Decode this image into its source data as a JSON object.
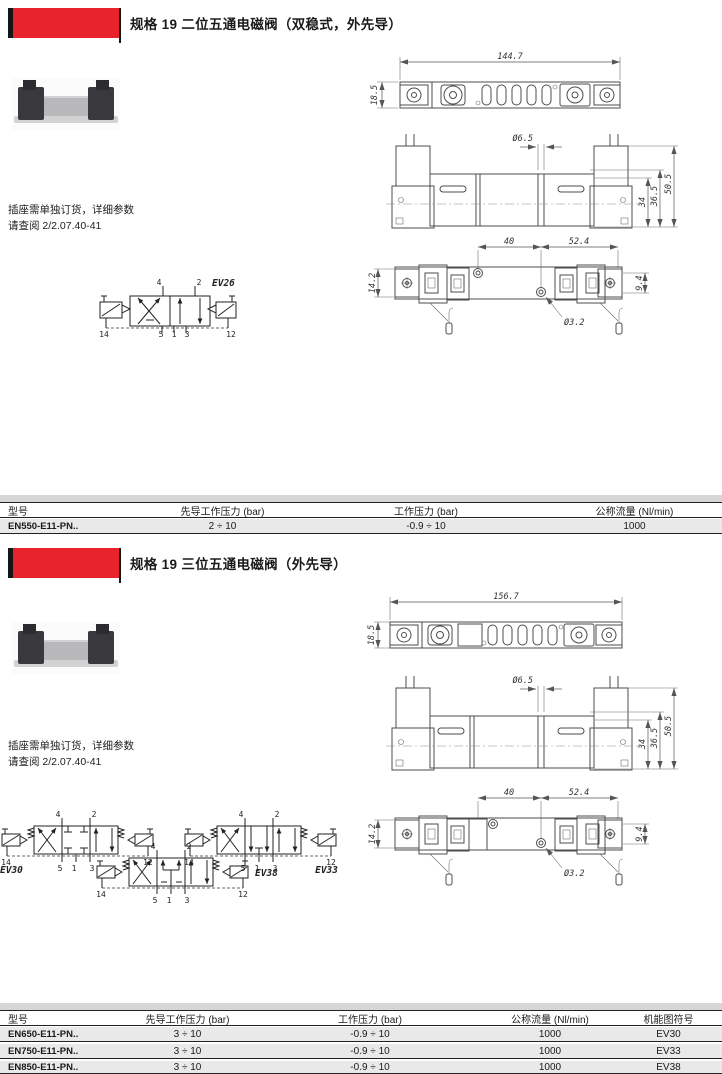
{
  "colors": {
    "accent_red": "#e8232b",
    "table_band_gray": "#d6d6d6",
    "table_row_gray": "#e9e9e9"
  },
  "section1": {
    "title": "规格 19 二位五通电磁阀（双稳式，外先导）",
    "note": {
      "line1": "插座需单独订货，详细参数",
      "line2": "请查阅 2/2.07.40-41"
    },
    "symbol": {
      "label": "EV26"
    },
    "ports": {
      "top": [
        "4",
        "2"
      ],
      "bottom": [
        "5",
        "1",
        "3"
      ],
      "left": "14",
      "right": "12"
    },
    "dims": {
      "top_length": "144.7",
      "top_height": "18.5",
      "front_hole": "Ø6.5",
      "front_h1": "34",
      "front_h2": "36.5",
      "front_h3": "50.5",
      "bottom_w1": "40",
      "bottom_w2": "52.4",
      "bottom_hl": "14.2",
      "bottom_hr": "9.4",
      "bottom_hole": "Ø3.2"
    },
    "table": {
      "headers": [
        "型号",
        "先导工作压力 (bar)",
        "工作压力 (bar)",
        "公称流量 (Nl/min)"
      ],
      "rows": [
        {
          "model": "EN550-E11-PN..",
          "pilot_pressure": "2 ÷ 10",
          "working_pressure": "-0.9 ÷ 10",
          "flow": "1000"
        }
      ]
    }
  },
  "section2": {
    "title": "规格 19 三位五通电磁阀（外先导）",
    "note": {
      "line1": "插座需单独订货，详细参数",
      "line2": "请查阅 2/2.07.40-41"
    },
    "symbols": [
      {
        "label": "EV30"
      },
      {
        "label": "EV33"
      },
      {
        "label": "EV38"
      }
    ],
    "ports": {
      "top": [
        "4",
        "2"
      ],
      "bottom": [
        "5",
        "1",
        "3"
      ],
      "left": "14",
      "right": "12"
    },
    "dims": {
      "top_length": "156.7",
      "top_height": "18.5",
      "front_hole": "Ø6.5",
      "front_h1": "34",
      "front_h2": "36.5",
      "front_h3": "50.5",
      "bottom_w1": "40",
      "bottom_w2": "52.4",
      "bottom_hl": "14.2",
      "bottom_hr": "9.4",
      "bottom_hole": "Ø3.2"
    },
    "table": {
      "headers": [
        "型号",
        "先导工作压力 (bar)",
        "工作压力 (bar)",
        "公称流量 (Nl/min)",
        "机能图符号"
      ],
      "rows": [
        {
          "model": "EN650-E11-PN..",
          "pilot_pressure": "3 ÷ 10",
          "working_pressure": "-0.9 ÷ 10",
          "flow": "1000",
          "symbol": "EV30"
        },
        {
          "model": "EN750-E11-PN..",
          "pilot_pressure": "3 ÷ 10",
          "working_pressure": "-0.9 ÷ 10",
          "flow": "1000",
          "symbol": "EV33"
        },
        {
          "model": "EN850-E11-PN..",
          "pilot_pressure": "3 ÷ 10",
          "working_pressure": "-0.9 ÷ 10",
          "flow": "1000",
          "symbol": "EV38"
        }
      ]
    }
  }
}
